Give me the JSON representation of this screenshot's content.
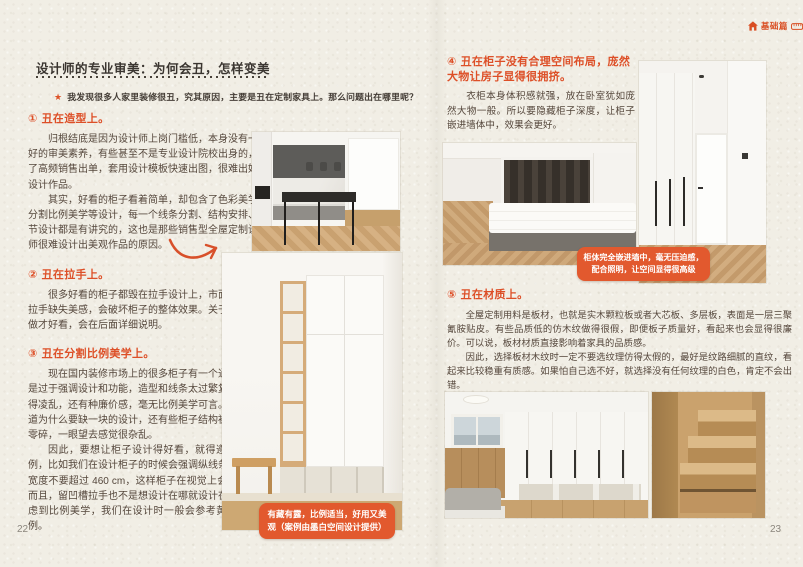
{
  "colors": {
    "accent": "#DD4F27",
    "caption_badge_bg": "#E2592E",
    "paper": "#F1EEE5",
    "body_text": "#55473C",
    "title_text": "#3A3530"
  },
  "icons": {
    "star": "★"
  },
  "corner_badge": {
    "label": "基础篇",
    "icons": [
      "house-icon",
      "ruler-icon"
    ]
  },
  "left_page": {
    "page_number": "22",
    "title": "设计师的专业审美：为何会丑，怎样变美",
    "intro": "我发现很多人家里装修很丑，究其原因，主要是丑在定制家具上。那么问题出在哪里呢？",
    "sections": [
      {
        "num": "①",
        "heading": "丑在造型上。",
        "paragraphs": [
          "归根结底是因为设计师上岗门槛低，本身没有一个好的审美素养，有些甚至不是专业设计院校出身的，为了高频销售出单，套用设计模板快速出图，很难出好的设计作品。",
          "其实，好看的柜子看着简单，却包含了色彩美学和分割比例美学等设计，每一个线条分割、结构安排、细节设计都是有讲究的，这也是那些销售型全屋定制设计师很难设计出美观作品的原因。"
        ]
      },
      {
        "num": "②",
        "heading": "丑在拉手上。",
        "paragraphs": [
          "很多好看的柜子都毁在拉手设计上，市面上的很多拉手缺失美感，会破坏柜子的整体效果。关于拉手怎样做才好看，会在后面详细说明。"
        ]
      },
      {
        "num": "③",
        "heading": "丑在分割比例美学上。",
        "paragraphs": [
          "现在国内装修市场上的很多柜子有一个通病，那就是过于强调设计和功能，造型和线条太过繁复，不但显得凌乱，还有种廉价感，毫无比例美学可言。比如不知道为什么要缺一块的设计，还有些柜子结构被切割得太零碎，一眼望去感觉很杂乱。",
          "因此，要想让柜子设计得好看，就得遵循美学比例，比如我们在设计柜子的时候会强调纵线条，单门板宽度不要超过 460 cm，这样柜子在视觉上会更好看。而且，留凹槽拉手也不是想设计在哪就设计在哪，要考虑到比例美学，我们在设计时一般会参考黄金分割比例。"
        ]
      }
    ],
    "photo_caption": "有藏有露，比例适当，好用又美观（案例由墨白空间设计提供）"
  },
  "right_page": {
    "page_number": "23",
    "sections": [
      {
        "num": "④",
        "heading": "丑在柜子没有合理空间布局，庞然大物让房子显得很拥挤。",
        "paragraphs": [
          "衣柜本身体积感就强，放在卧室犹如庞然大物一般。所以要隐藏柜子深度，让柜子嵌进墙体中，效果会更好。"
        ]
      },
      {
        "num": "⑤",
        "heading": "丑在材质上。",
        "paragraphs": [
          "全屋定制用料是板材，也就是实木颗粒板或者大芯板、多层板，表面是一层三聚氰胺贴皮。有些品质低的仿木纹做得很假，即便板子质量好，看起来也会显得很廉价。可以说，板材材质直接影响着家具的品质感。",
          "因此，选择板材木纹时一定不要选纹理仿得太假的，最好是纹路细腻的直纹，看起来比较稳重有质感。如果怕自己选不好，就选择没有任何纹理的白色，肯定不会出错。"
        ]
      }
    ],
    "photo_caption": "柜体完全嵌进墙中，毫无压迫感，配合照明，让空间显得很高级"
  }
}
